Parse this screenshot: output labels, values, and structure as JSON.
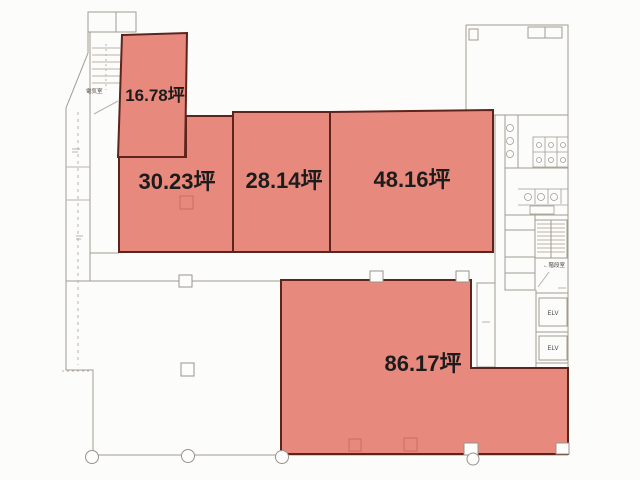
{
  "plan": {
    "areas": [
      {
        "name": "area-16-78",
        "label": "16.78坪"
      },
      {
        "name": "area-30-23",
        "label": "30.23坪"
      },
      {
        "name": "area-28-14",
        "label": "28.14坪"
      },
      {
        "name": "area-48-16",
        "label": "48.16坪"
      },
      {
        "name": "area-86-17",
        "label": "86.17坪"
      }
    ],
    "rooms": {
      "electrical_label": "電気室",
      "stair_label": "←階段室",
      "elevator_upper_label": "ELV",
      "elevator_lower_label": "ELV"
    },
    "colors": {
      "highlight_fill": "#e8897e",
      "highlight_border": "#5c241c",
      "wall_line": "#a29b92",
      "text": "#1c1c1c"
    }
  }
}
